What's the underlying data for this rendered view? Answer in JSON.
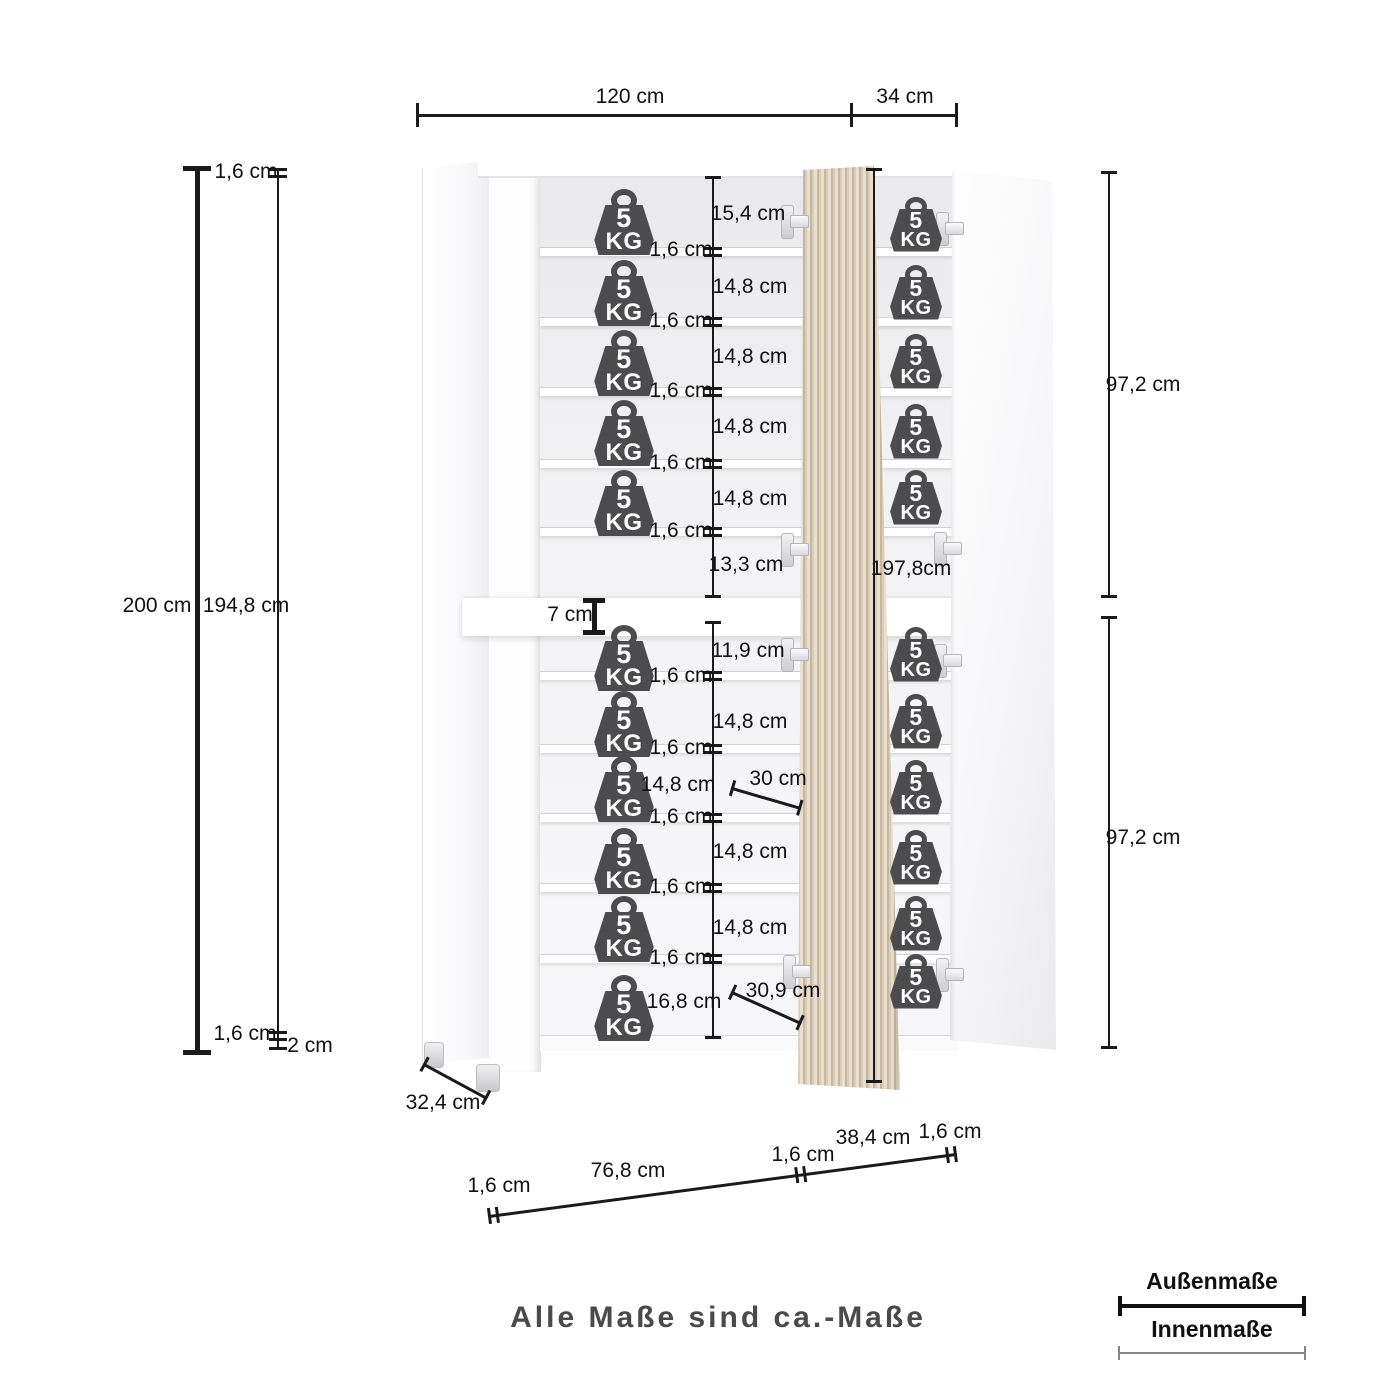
{
  "note": "Alle Maße sind ca.-Maße",
  "legend": {
    "outer_label": "Außenmaße",
    "inner_label": "Innenmaße"
  },
  "weight_badge": {
    "value": "5",
    "unit": "KG"
  },
  "colors": {
    "line": "#1a1a1a",
    "weight_icon": "#4c4c4f",
    "wood_light": "#e8dfce",
    "wood_dark": "#c6b79f",
    "note_text": "#4a4a4c"
  },
  "dim_labels": [
    {
      "text": "120 cm",
      "x": 630,
      "y": 97
    },
    {
      "text": "34 cm",
      "x": 905,
      "y": 97
    },
    {
      "text": "1,6 cm",
      "x": 246,
      "y": 172
    },
    {
      "text": "200 cm",
      "x": 157,
      "y": 606
    },
    {
      "text": "194,8 cm",
      "x": 246,
      "y": 606
    },
    {
      "text": "1,6 cm",
      "x": 245,
      "y": 1034
    },
    {
      "text": "2 cm",
      "x": 310,
      "y": 1046
    },
    {
      "text": "15,4 cm",
      "x": 748,
      "y": 214
    },
    {
      "text": "1,6 cm",
      "x": 681,
      "y": 250
    },
    {
      "text": "14,8 cm",
      "x": 750,
      "y": 287
    },
    {
      "text": "1,6 cm",
      "x": 681,
      "y": 321
    },
    {
      "text": "14,8 cm",
      "x": 750,
      "y": 357
    },
    {
      "text": "1,6 cm",
      "x": 681,
      "y": 391
    },
    {
      "text": "14,8 cm",
      "x": 750,
      "y": 427
    },
    {
      "text": "1,6 cm",
      "x": 681,
      "y": 463
    },
    {
      "text": "14,8 cm",
      "x": 750,
      "y": 499
    },
    {
      "text": "1,6 cm",
      "x": 681,
      "y": 531
    },
    {
      "text": "13,3 cm",
      "x": 746,
      "y": 565
    },
    {
      "text": "7 cm",
      "x": 570,
      "y": 615
    },
    {
      "text": "197,8cm",
      "x": 911,
      "y": 569
    },
    {
      "text": "11,9 cm",
      "x": 748,
      "y": 651
    },
    {
      "text": "1,6 cm",
      "x": 681,
      "y": 676
    },
    {
      "text": "14,8 cm",
      "x": 750,
      "y": 722
    },
    {
      "text": "1,6 cm",
      "x": 681,
      "y": 748
    },
    {
      "text": "14,8 cm",
      "x": 678,
      "y": 785
    },
    {
      "text": "30 cm",
      "x": 778,
      "y": 779
    },
    {
      "text": "1,6 cm",
      "x": 681,
      "y": 817
    },
    {
      "text": "14,8 cm",
      "x": 750,
      "y": 852
    },
    {
      "text": "1,6 cm",
      "x": 681,
      "y": 887
    },
    {
      "text": "14,8 cm",
      "x": 750,
      "y": 928
    },
    {
      "text": "1,6 cm",
      "x": 681,
      "y": 958
    },
    {
      "text": "16,8 cm",
      "x": 684,
      "y": 1002
    },
    {
      "text": "30,9 cm",
      "x": 783,
      "y": 991
    },
    {
      "text": "97,2 cm",
      "x": 1143,
      "y": 385
    },
    {
      "text": "97,2 cm",
      "x": 1143,
      "y": 838
    },
    {
      "text": "32,4 cm",
      "x": 443,
      "y": 1103
    },
    {
      "text": "1,6 cm",
      "x": 499,
      "y": 1186
    },
    {
      "text": "76,8 cm",
      "x": 628,
      "y": 1171
    },
    {
      "text": "1,6 cm",
      "x": 803,
      "y": 1155
    },
    {
      "text": "38,4 cm",
      "x": 873,
      "y": 1138
    },
    {
      "text": "1,6 cm",
      "x": 950,
      "y": 1132
    }
  ],
  "dim_lines": {
    "horizontal": [
      {
        "y": 115,
        "x1": 417,
        "x2": 956,
        "w": 3,
        "caps": [
          417,
          851,
          956
        ],
        "capLen": 24
      }
    ],
    "vertical": [
      {
        "x": 197,
        "y1": 168,
        "y2": 1052,
        "w": 5,
        "capLen": 28,
        "caps": [
          168,
          1052
        ]
      },
      {
        "x": 278,
        "y1": 168,
        "y2": 1049,
        "w": 2,
        "ticks": [
          169,
          176,
          1032,
          1039,
          1048
        ]
      },
      {
        "x": 713,
        "y1": 178,
        "y2": 597,
        "w": 2,
        "capLen": 16,
        "caps": [
          178,
          597
        ],
        "ticks": [
          248,
          255,
          318,
          325,
          388,
          395,
          460,
          467,
          528,
          535
        ]
      },
      {
        "x": 713,
        "y1": 623,
        "y2": 1038,
        "w": 2,
        "capLen": 16,
        "caps": [
          623,
          1038
        ],
        "ticks": [
          672,
          679,
          745,
          752,
          814,
          821,
          884,
          891,
          955,
          962
        ]
      },
      {
        "x": 874,
        "y1": 170,
        "y2": 1082,
        "w": 2,
        "capLen": 16,
        "caps": [
          170,
          1082
        ]
      },
      {
        "x": 594,
        "y1": 600,
        "y2": 632,
        "w": 5,
        "capLen": 22,
        "caps": [
          600,
          632
        ]
      },
      {
        "x": 1109,
        "y1": 173,
        "y2": 597,
        "w": 2,
        "capLen": 16,
        "caps": [
          173,
          597
        ]
      },
      {
        "x": 1109,
        "y1": 618,
        "y2": 1048,
        "w": 2,
        "capLen": 16,
        "caps": [
          618,
          1048
        ]
      }
    ],
    "diagonal": [
      {
        "x": 424,
        "y": 1063,
        "len": 72,
        "angle": 28.4,
        "ticks": [
          0,
          70
        ]
      },
      {
        "x": 732,
        "y": 787,
        "len": 72,
        "angle": 16.2,
        "ticks": [
          0,
          70
        ]
      },
      {
        "x": 732,
        "y": 991,
        "len": 76,
        "angle": 24.2,
        "ticks": [
          0,
          74
        ]
      },
      {
        "x": 489,
        "y": 1215,
        "len": 472,
        "angle": -7.56,
        "ticks": [
          0,
          8,
          310,
          318,
          462,
          470
        ]
      }
    ]
  },
  "weights": [
    {
      "x": 624,
      "y": 222,
      "s": "lg"
    },
    {
      "x": 624,
      "y": 293,
      "s": "lg"
    },
    {
      "x": 624,
      "y": 363,
      "s": "lg"
    },
    {
      "x": 624,
      "y": 433,
      "s": "lg"
    },
    {
      "x": 624,
      "y": 503,
      "s": "lg"
    },
    {
      "x": 624,
      "y": 658,
      "s": "lg"
    },
    {
      "x": 624,
      "y": 724,
      "s": "lg"
    },
    {
      "x": 624,
      "y": 789,
      "s": "lg"
    },
    {
      "x": 624,
      "y": 861,
      "s": "lg"
    },
    {
      "x": 624,
      "y": 929,
      "s": "lg"
    },
    {
      "x": 624,
      "y": 1008,
      "s": "lg"
    },
    {
      "x": 916,
      "y": 224,
      "s": "sm"
    },
    {
      "x": 916,
      "y": 292,
      "s": "sm"
    },
    {
      "x": 916,
      "y": 361,
      "s": "sm"
    },
    {
      "x": 916,
      "y": 431,
      "s": "sm"
    },
    {
      "x": 916,
      "y": 497,
      "s": "sm"
    },
    {
      "x": 916,
      "y": 654,
      "s": "sm"
    },
    {
      "x": 916,
      "y": 721,
      "s": "sm"
    },
    {
      "x": 916,
      "y": 787,
      "s": "sm"
    },
    {
      "x": 916,
      "y": 857,
      "s": "sm"
    },
    {
      "x": 916,
      "y": 923,
      "s": "sm"
    },
    {
      "x": 916,
      "y": 981,
      "s": "sm"
    }
  ],
  "hinges": [
    {
      "x": 781,
      "y": 205
    },
    {
      "x": 936,
      "y": 212
    },
    {
      "x": 781,
      "y": 533
    },
    {
      "x": 934,
      "y": 532
    },
    {
      "x": 781,
      "y": 638
    },
    {
      "x": 934,
      "y": 644
    },
    {
      "x": 783,
      "y": 955
    },
    {
      "x": 936,
      "y": 958
    }
  ],
  "cabinet": {
    "shelf_rows": [
      247,
      317,
      387,
      459,
      527,
      671,
      744,
      813,
      883,
      954
    ],
    "feet": [
      {
        "x": 424,
        "y": 1042,
        "w": 18,
        "h": 24
      },
      {
        "x": 476,
        "y": 1064,
        "w": 22,
        "h": 26
      }
    ]
  }
}
